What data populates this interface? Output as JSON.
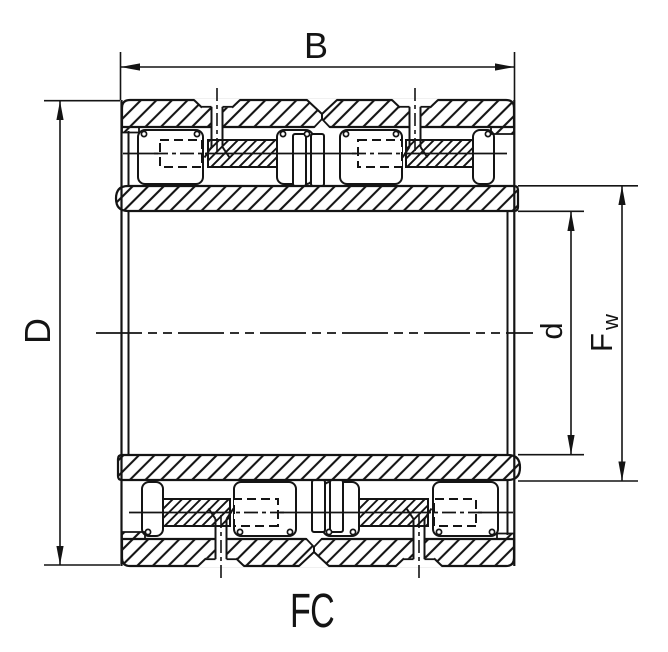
{
  "drawing": {
    "type_label": "FC",
    "dimensions": {
      "width": {
        "label": "B"
      },
      "outer_diameter": {
        "label": "D"
      },
      "bore_diameter": {
        "label": "d"
      },
      "raceway_diameter": {
        "label_main": "F",
        "label_sub": "w"
      }
    },
    "colors": {
      "ink": "#141414",
      "background": "#ffffff"
    }
  }
}
